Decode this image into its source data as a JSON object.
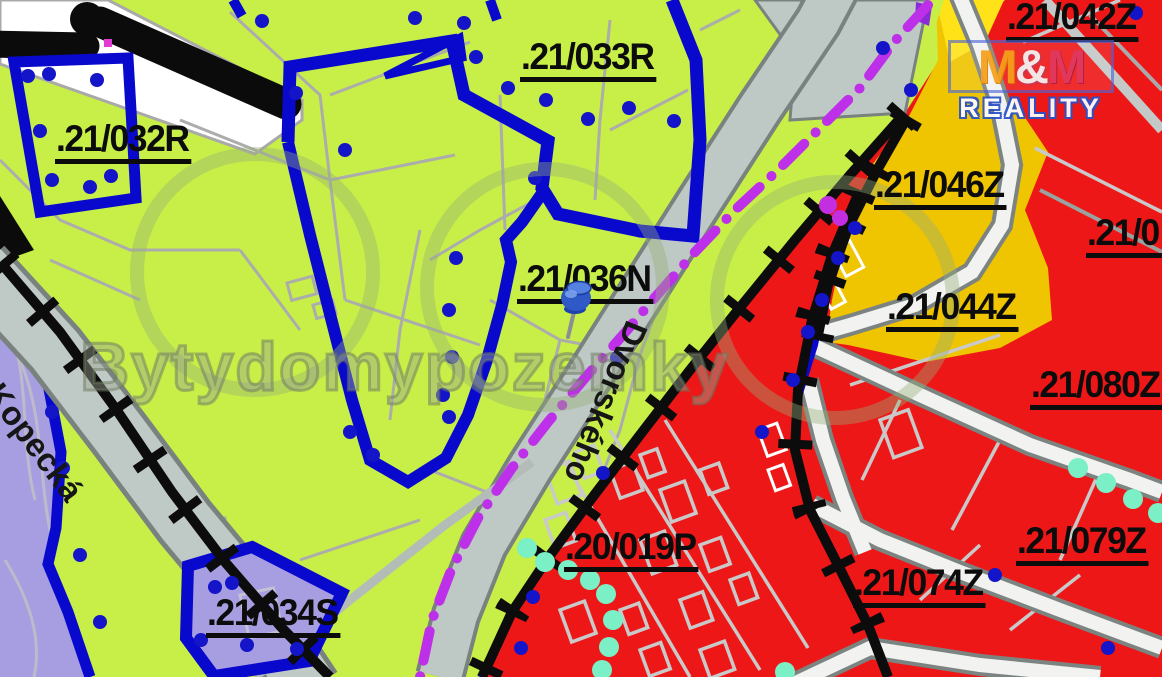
{
  "map": {
    "title": "cadastral zoning map",
    "parcel_labels": {
      "p032R": ".21/032R",
      "p033R": ".21/033R",
      "p036N": ".21/036N",
      "p034S": ".21/034S",
      "p019P": ".20/019P",
      "p042Z": ".21/042Z",
      "p046Z": ".21/046Z",
      "p044Z": ".21/044Z",
      "p080Z": ".21/080Z",
      "p079Z": ".21/079Z",
      "p074Z": ".21/074Z",
      "p_cut_right_edge": ".21/0"
    },
    "streets": {
      "kopecka": "Kopecká",
      "dvorskeho": "Dvorského"
    },
    "watermark": {
      "text": "Bytydomypozemky"
    },
    "logo": {
      "m1": "M",
      "amp": "&",
      "m2": "M",
      "reality": "REALITY"
    },
    "marker": {
      "name": "blue-pushpin"
    },
    "colors": {
      "zone_green": "#C7EF47",
      "zone_red": "#EE1717",
      "zone_yellow": "#EFC400",
      "zone_yellow_bright": "#FFE318",
      "zone_purple": "#A79EE2",
      "boundary_blue": "#0909CE",
      "boundary_black": "#0C0C0C",
      "dashline_magenta": "#BD2FE8",
      "dots_aqua": "#7BEFC6",
      "road_gray": "#BEC8C4",
      "road_white": "#F2F2F0"
    }
  }
}
